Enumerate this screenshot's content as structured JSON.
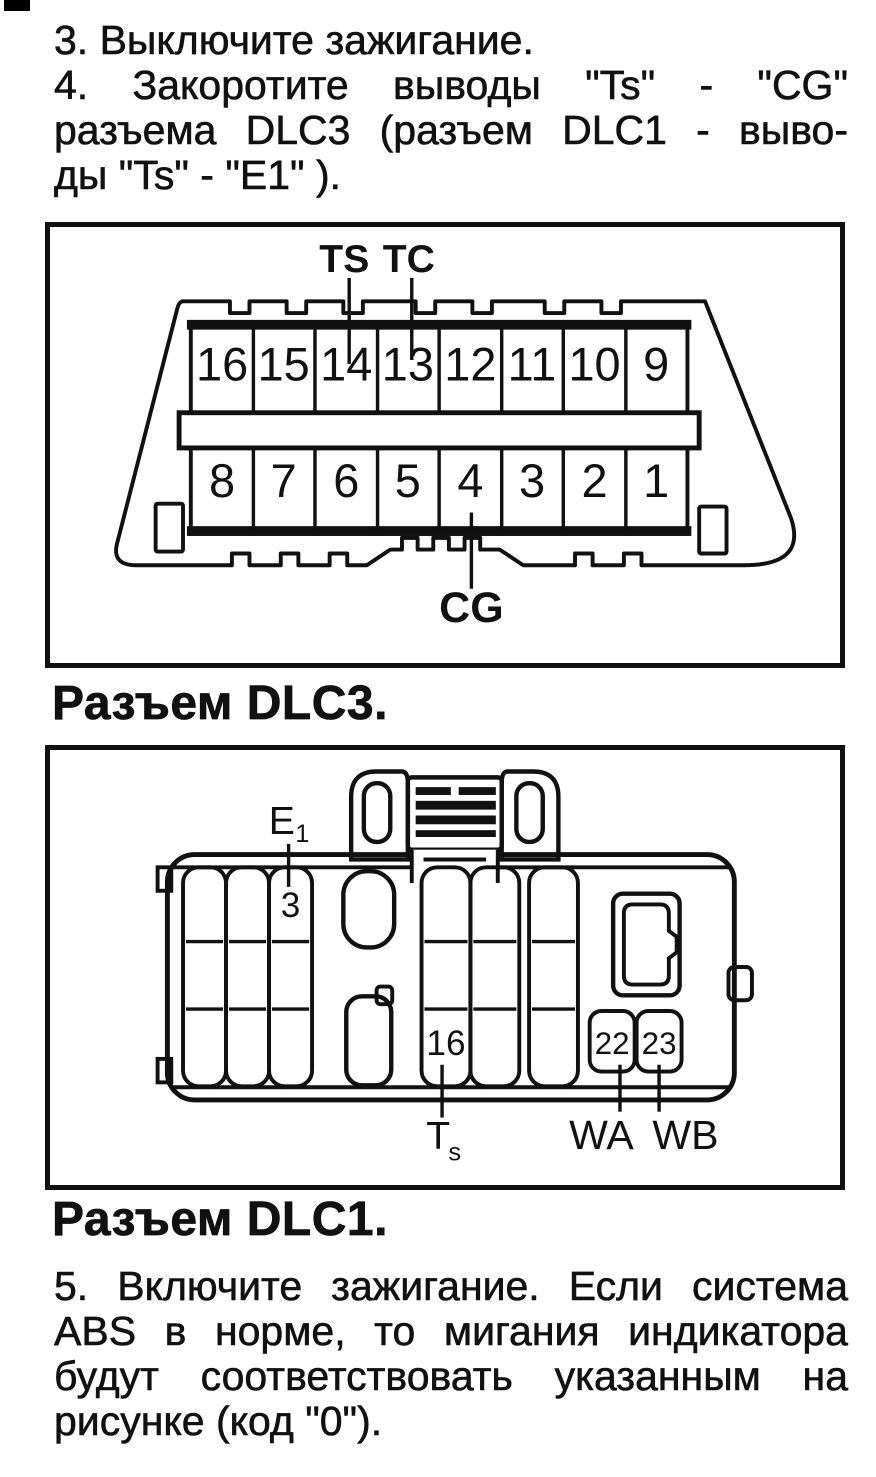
{
  "page": {
    "background": "#ffffff",
    "ink": "#111111"
  },
  "steps": {
    "step34": {
      "lines": [
        "3. Выключите зажигание.",
        "4. Закоротите выводы \"Ts\" - \"CG\"",
        "разъема DLC3 (разъем DLC1 - выво-",
        "ды \"Ts\" - \"E1\" )."
      ]
    },
    "step5": {
      "lines": [
        "5. Включите зажигание. Если система",
        "ABS в норме, то мигания индикатора",
        "будут соответствовать указанным на",
        "рисунке (код \"0\")."
      ]
    }
  },
  "figure_dlc3": {
    "caption": "Разъем DLC3.",
    "labels": {
      "ts": "TS",
      "tc": "TC",
      "cg": "CG"
    },
    "pins_top": [
      "16",
      "15",
      "14",
      "13",
      "12",
      "11",
      "10",
      "9"
    ],
    "pins_bottom": [
      "8",
      "7",
      "6",
      "5",
      "4",
      "3",
      "2",
      "1"
    ]
  },
  "figure_dlc1": {
    "caption": "Разъем DLC1.",
    "labels": {
      "e1_base": "E",
      "e1_sub": "1",
      "ts_base": "T",
      "ts_sub": "s",
      "wa": "WA",
      "wb": "WB"
    },
    "pins": {
      "pin3": "3",
      "pin16": "16",
      "pin22": "22",
      "pin23": "23"
    }
  }
}
